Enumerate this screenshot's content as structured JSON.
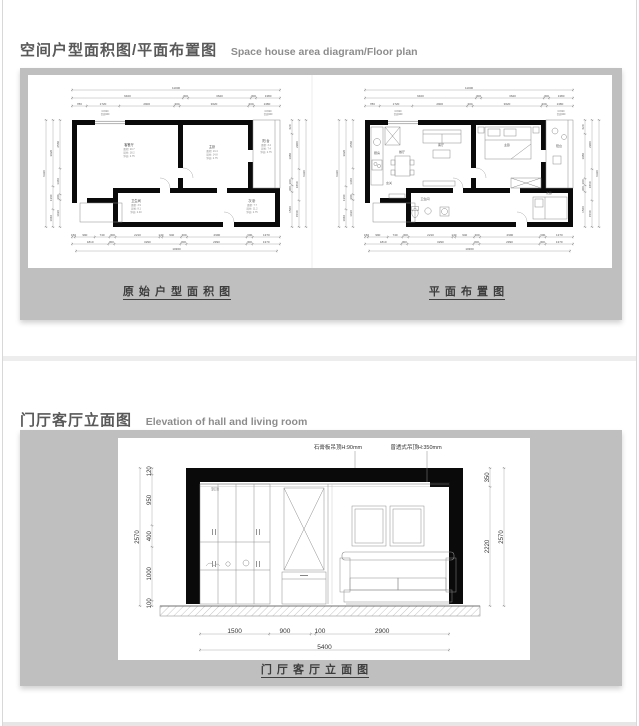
{
  "page": {
    "background": "#ffffff",
    "panel_gray": "#bfbfbf",
    "edge_line": "#d8d8d8"
  },
  "sections": [
    {
      "title_zh": "空间户型面积图/平面布置图",
      "title_en": "Space house area diagram/Floor plan",
      "captions": [
        "原 始 户 型 面 积 图",
        "平 面 布 置 图"
      ]
    },
    {
      "title_zh": "门厅客厅立面图",
      "title_en": "Elevation of hall and living room",
      "caption": "门 厅 客 厅 立 面 图"
    }
  ],
  "floorplan_dims": {
    "top_total": "11000",
    "top_row1": [
      "6400",
      "300",
      "3620",
      "300",
      "1380"
    ],
    "top_row2": [
      "780",
      "1720",
      "2900",
      "300",
      "3620",
      "300",
      "1380"
    ],
    "bottom_row1": [
      "150",
      "990",
      "740",
      "300",
      "2210",
      "140",
      "940",
      "300",
      "2990",
      "300",
      "1370"
    ],
    "bottom_row2": [
      "1810",
      "300",
      "3290",
      "300",
      "2990",
      "300",
      "1370"
    ],
    "bottom_total": "10360",
    "left_col1": [
      "2560",
      "1360",
      "300",
      "1430"
    ],
    "left_col2": [
      "3920",
      "1360",
      "1040"
    ],
    "left_total": "6320",
    "right_col1": [
      "620",
      "1980",
      "300",
      "300",
      "1560"
    ],
    "right_col2": [
      "2900",
      "1860",
      "1560"
    ],
    "right_total": "6320",
    "window_tags": [
      "C1520",
      "台高900"
    ]
  },
  "plan_a": {
    "rooms": [
      {
        "name": "客餐厅",
        "lines": [
          "面积: 20.7",
          "周长: 18.2",
          "净高: 2.75"
        ]
      },
      {
        "name": "主卧",
        "lines": [
          "面积: 13.4",
          "周长: 14.8",
          "净高: 2.75"
        ]
      },
      {
        "name": "阳 台",
        "lines": [
          "面积: 3.4",
          "周长: 7.4",
          "净高: 2.75"
        ]
      },
      {
        "name": "卫生间",
        "lines": [
          "面积: 3.9",
          "周长: 8.1",
          "净高: 2.40"
        ]
      },
      {
        "name": "次 卧",
        "lines": [
          "面积: 7.7",
          "周长: 11.2",
          "净高: 2.75"
        ]
      }
    ]
  },
  "plan_b": {
    "labels": [
      "厨房",
      "客厅",
      "餐厅",
      "主卧",
      "阳台",
      "卫生间",
      "次卧",
      "玄关"
    ]
  },
  "elevation": {
    "annotations": [
      "石膏板吊顶H:90mm",
      "曾透式吊顶H:350mm"
    ],
    "left_total": "2570",
    "left_segments": [
      "120",
      "950",
      "400",
      "1000",
      "100"
    ],
    "right_segments": [
      "350",
      "2220"
    ],
    "right_total": "2570",
    "bottom_segments": [
      "1500",
      "900",
      "100",
      "2900"
    ],
    "bottom_total": "5400",
    "cabinet_label": "到顶"
  }
}
